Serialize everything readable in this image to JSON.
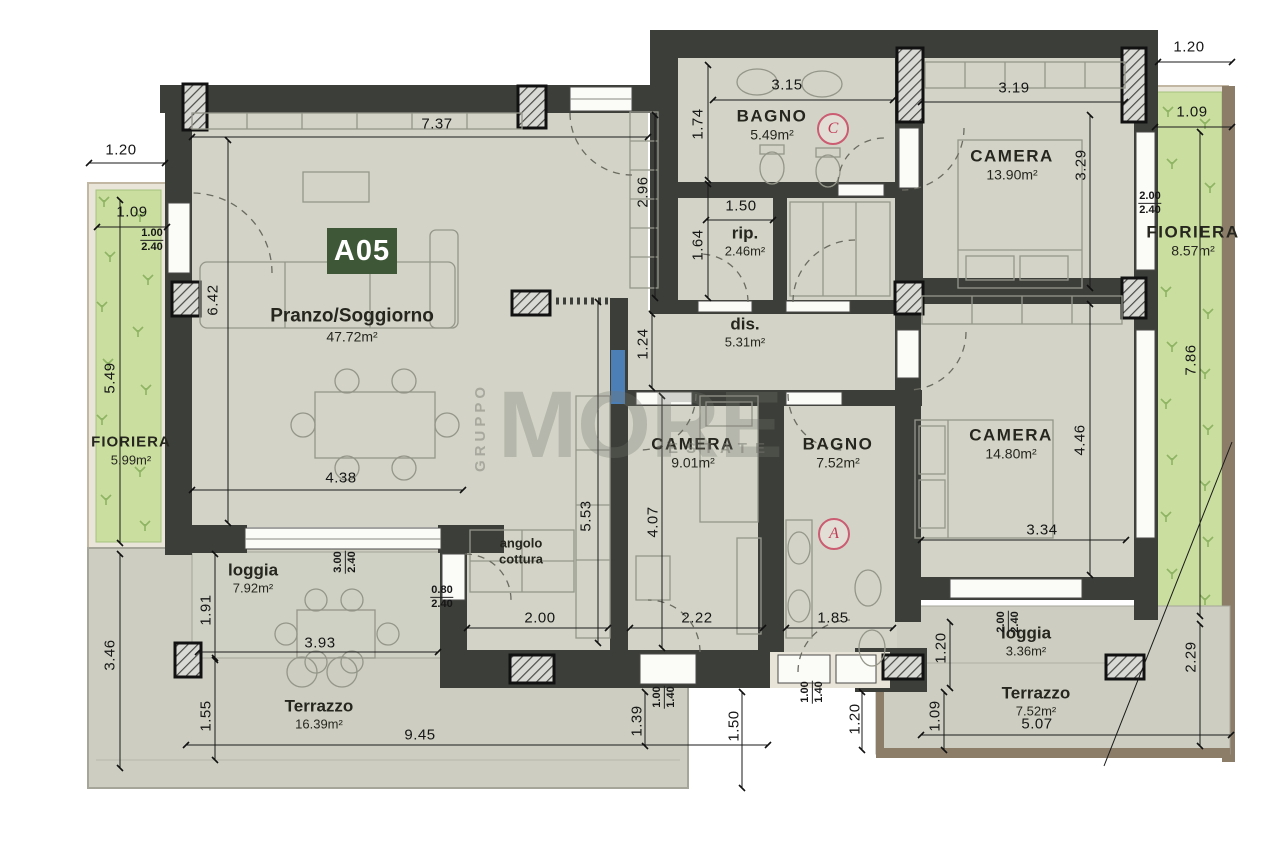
{
  "plan": {
    "unit_label": "A05",
    "watermark": {
      "vertical": "GRUPPO",
      "main": "MORE",
      "sub": "ESTATE"
    },
    "door_markers": [
      {
        "letter": "C",
        "x": 833,
        "y": 129
      },
      {
        "letter": "A",
        "x": 834,
        "y": 534
      }
    ],
    "rooms": [
      {
        "name": "BAGNO",
        "area": "5.49m²",
        "x": 772,
        "y": 125,
        "style": "caps"
      },
      {
        "name": "CAMERA",
        "area": "13.90m²",
        "x": 1012,
        "y": 165,
        "style": "caps"
      },
      {
        "name": "FIORIERA",
        "area": "8.57m²",
        "x": 1193,
        "y": 241,
        "style": "caps"
      },
      {
        "name": "rip.",
        "area": "2.46m²",
        "x": 745,
        "y": 241,
        "style": "small"
      },
      {
        "name": "dis.",
        "area": "5.31m²",
        "x": 745,
        "y": 332,
        "style": "small"
      },
      {
        "name": "Pranzo/Soggiorno",
        "area": "47.72m²",
        "x": 352,
        "y": 325,
        "style": "big"
      },
      {
        "name": "CAMERA",
        "area": "9.01m²",
        "x": 693,
        "y": 453,
        "style": "caps"
      },
      {
        "name": "BAGNO",
        "area": "7.52m²",
        "x": 838,
        "y": 453,
        "style": "caps"
      },
      {
        "name": "CAMERA",
        "area": "14.80m²",
        "x": 1011,
        "y": 444,
        "style": "caps"
      },
      {
        "name": "FIORIERA",
        "area": "5.99m²",
        "x": 131,
        "y": 451,
        "style": "capsm"
      },
      {
        "name": "loggia",
        "area": "7.92m²",
        "x": 253,
        "y": 578,
        "style": "small"
      },
      {
        "name": "angolo\ncottura",
        "area": "",
        "x": 521,
        "y": 551,
        "style": "tiny"
      },
      {
        "name": "Terrazzo",
        "area": "16.39m²",
        "x": 319,
        "y": 714,
        "style": "small"
      },
      {
        "name": "loggia",
        "area": "3.36m²",
        "x": 1026,
        "y": 641,
        "style": "small"
      },
      {
        "name": "Terrazzo",
        "area": "7.52m²",
        "x": 1036,
        "y": 701,
        "style": "small"
      }
    ],
    "dimensions": [
      {
        "text": "7.37",
        "x": 437,
        "y": 124,
        "rot": 0
      },
      {
        "text": "3.15",
        "x": 787,
        "y": 85,
        "rot": 0
      },
      {
        "text": "3.19",
        "x": 1014,
        "y": 88,
        "rot": 0
      },
      {
        "text": "1.20",
        "x": 1189,
        "y": 47,
        "rot": 0
      },
      {
        "text": "1.09",
        "x": 1192,
        "y": 112,
        "rot": 0
      },
      {
        "text": "1.20",
        "x": 121,
        "y": 150,
        "rot": 0
      },
      {
        "text": "1.09",
        "x": 132,
        "y": 212,
        "rot": 0
      },
      {
        "text": "6.42",
        "x": 213,
        "y": 300,
        "rot": 90
      },
      {
        "text": "5.49",
        "x": 110,
        "y": 378,
        "rot": 90
      },
      {
        "text": "2.96",
        "x": 643,
        "y": 192,
        "rot": 90
      },
      {
        "text": "1.74",
        "x": 698,
        "y": 124,
        "rot": 90
      },
      {
        "text": "1.50",
        "x": 741,
        "y": 206,
        "rot": 0
      },
      {
        "text": "1.64",
        "x": 698,
        "y": 245,
        "rot": 90
      },
      {
        "text": "1.24",
        "x": 643,
        "y": 344,
        "rot": 90
      },
      {
        "text": "5.53",
        "x": 586,
        "y": 516,
        "rot": 90
      },
      {
        "text": "4.07",
        "x": 653,
        "y": 522,
        "rot": 90
      },
      {
        "text": "4.38",
        "x": 341,
        "y": 478,
        "rot": 0
      },
      {
        "text": "3.29",
        "x": 1081,
        "y": 165,
        "rot": 90
      },
      {
        "text": "7.86",
        "x": 1191,
        "y": 360,
        "rot": 90
      },
      {
        "text": "4.46",
        "x": 1080,
        "y": 440,
        "rot": 90
      },
      {
        "text": "3.34",
        "x": 1042,
        "y": 530,
        "rot": 0
      },
      {
        "text": "1.91",
        "x": 206,
        "y": 610,
        "rot": 90
      },
      {
        "text": "3.46",
        "x": 110,
        "y": 655,
        "rot": 90
      },
      {
        "text": "1.55",
        "x": 206,
        "y": 716,
        "rot": 90
      },
      {
        "text": "3.93",
        "x": 320,
        "y": 643,
        "rot": 0
      },
      {
        "text": "2.00",
        "x": 540,
        "y": 618,
        "rot": 0
      },
      {
        "text": "2.22",
        "x": 697,
        "y": 618,
        "rot": 0
      },
      {
        "text": "1.85",
        "x": 833,
        "y": 618,
        "rot": 0
      },
      {
        "text": "9.45",
        "x": 420,
        "y": 735,
        "rot": 0
      },
      {
        "text": "1.39",
        "x": 637,
        "y": 721,
        "rot": 90
      },
      {
        "text": "1.50",
        "x": 734,
        "y": 726,
        "rot": 90
      },
      {
        "text": "1.20",
        "x": 855,
        "y": 719,
        "rot": 90
      },
      {
        "text": "1.20",
        "x": 941,
        "y": 648,
        "rot": 90
      },
      {
        "text": "1.09",
        "x": 935,
        "y": 716,
        "rot": 90
      },
      {
        "text": "2.29",
        "x": 1191,
        "y": 657,
        "rot": 90
      },
      {
        "text": "5.07",
        "x": 1037,
        "y": 724,
        "rot": 0
      }
    ],
    "window_labels": [
      {
        "top": "1.00",
        "bottom": "2.40",
        "x": 152,
        "y": 240,
        "rot": 0
      },
      {
        "top": "2.00",
        "bottom": "2.40",
        "x": 1150,
        "y": 203,
        "rot": 0
      },
      {
        "top": "0.80",
        "bottom": "2.40",
        "x": 442,
        "y": 597,
        "rot": 0
      },
      {
        "top": "3.00",
        "bottom": "2.40",
        "x": 345,
        "y": 562,
        "rot": 90
      },
      {
        "top": "1.00",
        "bottom": "1.40",
        "x": 664,
        "y": 697,
        "rot": 90
      },
      {
        "top": "1.00",
        "bottom": "1.40",
        "x": 812,
        "y": 692,
        "rot": 90
      },
      {
        "top": "2.00",
        "bottom": "2.40",
        "x": 1008,
        "y": 622,
        "rot": 90
      }
    ]
  }
}
